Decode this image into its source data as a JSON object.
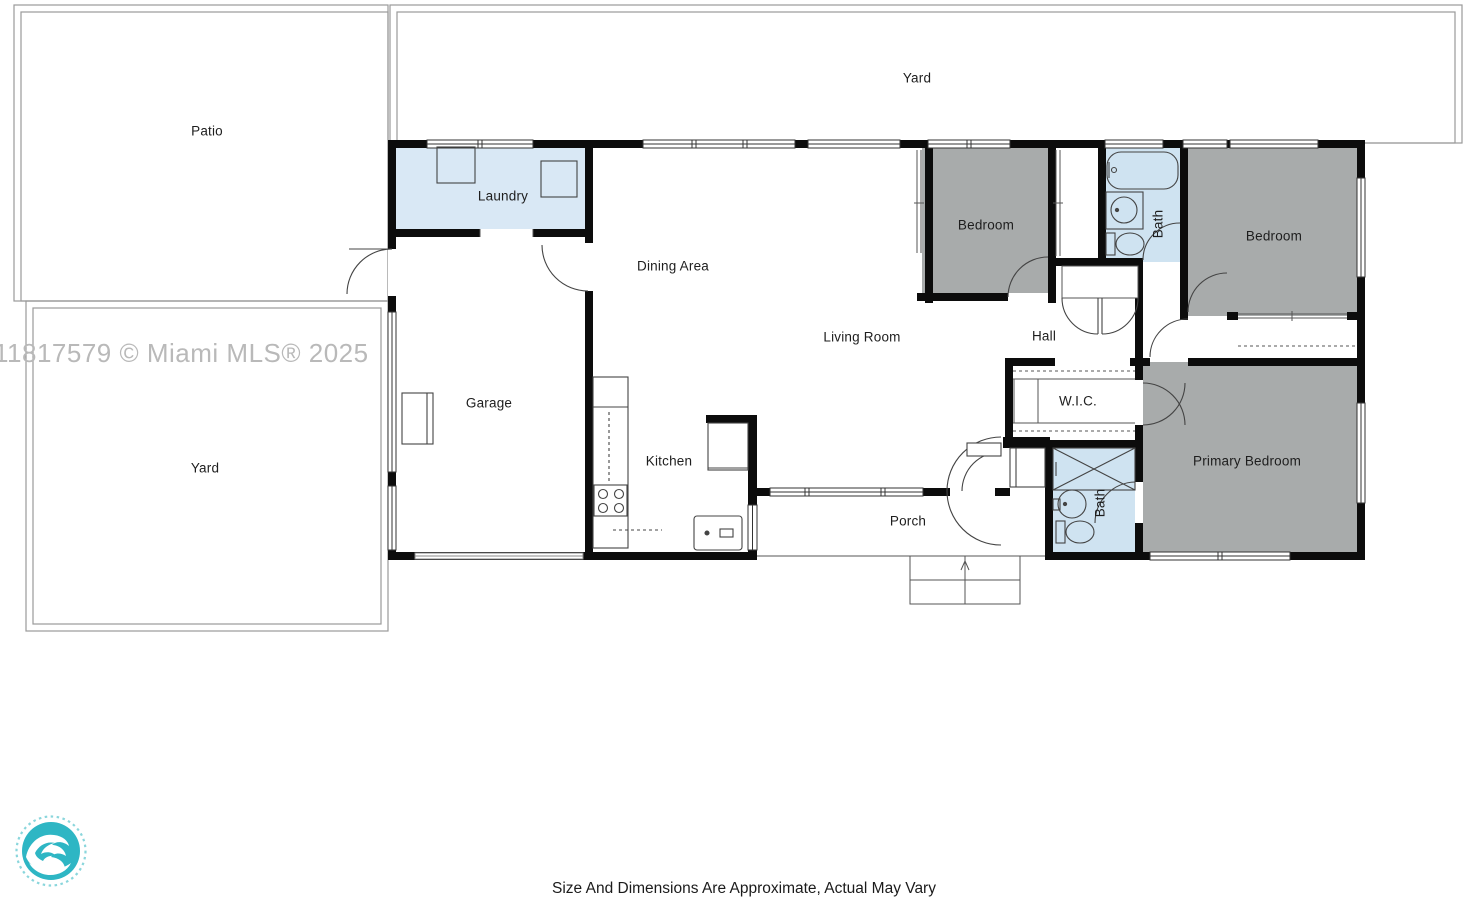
{
  "watermark": {
    "text": "11817579 © Miami MLS® 2025"
  },
  "footer": {
    "disclaimer": "Size And Dimensions Are Approximate, Actual May Vary"
  },
  "logo": {
    "icon": "wave-logo",
    "color": "#2eb6c4",
    "ring_color": "#8ad6dc"
  },
  "floorplan": {
    "outdoor_labels": {
      "patio": "Patio",
      "yard_top": "Yard",
      "yard_left": "Yard"
    },
    "room_labels": {
      "laundry": "Laundry",
      "dining": "Dining Area",
      "garage": "Garage",
      "kitchen": "Kitchen",
      "living": "Living Room",
      "porch": "Porch",
      "hall": "Hall",
      "wic": "W.I.C.",
      "bedroom_left": "Bedroom",
      "bedroom_right": "Bedroom",
      "primary_bedroom": "Primary Bedroom",
      "bath_top": "Bath",
      "bath_bottom": "Bath"
    },
    "colors": {
      "wall": "#0c0c0c",
      "bedroom_fill": "#a8abab",
      "bath_fill": "#cfe3f1",
      "laundry_fill": "#d9e8f5",
      "outdoor_line": "#9a9a9a"
    }
  }
}
